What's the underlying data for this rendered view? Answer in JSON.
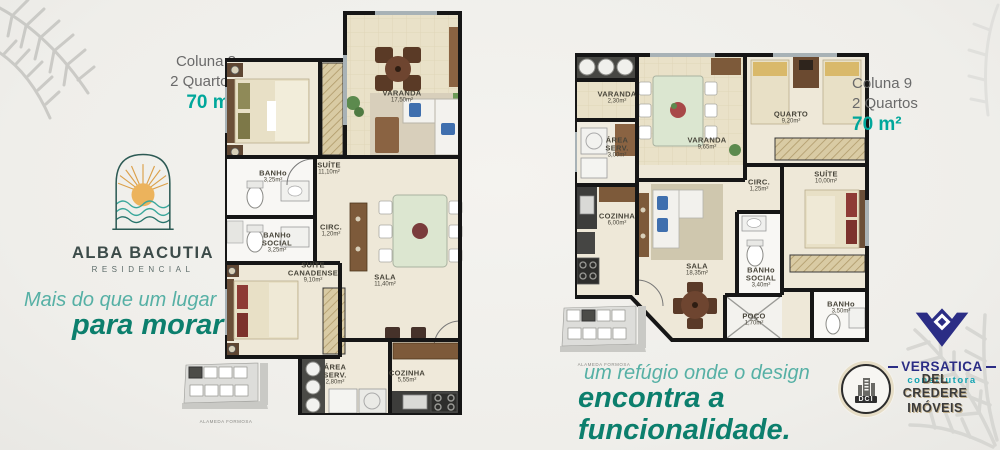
{
  "brand": {
    "name": "ALBA BACUTIA",
    "subtitle": "RESIDENCIAL"
  },
  "taglines": {
    "left1": "Mais do que um lugar",
    "left2": "para morar",
    "right1": "um refúgio onde o design",
    "right2": "encontra a funcionalidade."
  },
  "plan8": {
    "header": {
      "column": "Coluna 8",
      "type": "2 Quartos",
      "size": "70 m²"
    },
    "rooms": [
      {
        "name": "VARANDA",
        "area": "17,50m²"
      },
      {
        "name": "SUÍTE",
        "area": "11,10m²"
      },
      {
        "name": "BANHo",
        "area": "3,25m²"
      },
      {
        "name": "BANHo SOCIAL",
        "area": "3,25m²"
      },
      {
        "name": "CIRC.",
        "area": "1,20m²"
      },
      {
        "name": "SUÍTE CANADENSE",
        "area": "9,10m²"
      },
      {
        "name": "SALA",
        "area": "11,40m²"
      },
      {
        "name": "ÁREA SERV.",
        "area": "2,80m²"
      },
      {
        "name": "COZINHA",
        "area": "5,55m²"
      }
    ]
  },
  "plan9": {
    "header": {
      "column": "Coluna 9",
      "type": "2 Quartos",
      "size": "70 m²"
    },
    "rooms": [
      {
        "name": "VARANDA",
        "area": "2,30m²"
      },
      {
        "name": "ÁREA SERV.",
        "area": "3,00m²"
      },
      {
        "name": "VARANDA",
        "area": "9,65m²"
      },
      {
        "name": "QUARTO",
        "area": "9,20m²"
      },
      {
        "name": "CIRC.",
        "area": "1,25m²"
      },
      {
        "name": "SUÍTE",
        "area": "10,00m²"
      },
      {
        "name": "COZINHA",
        "area": "6,00m²"
      },
      {
        "name": "SALA",
        "area": "18,35m²"
      },
      {
        "name": "BANHo SOCIAL",
        "area": "3,40m²"
      },
      {
        "name": "POÇO",
        "area": "1,70m²"
      },
      {
        "name": "BANHo",
        "area": "3,50m²"
      }
    ]
  },
  "keyplan": {
    "street": "ALAMEDA FORMOSA"
  },
  "partners": {
    "versatica": {
      "name": "VERSATICA",
      "subtitle": "construtora"
    },
    "delcredere": {
      "badge": "DCI",
      "line1": "DEL CREDERE",
      "line2": "IMÓVEIS"
    }
  },
  "colors": {
    "accent_teal": "#00a79b",
    "teal_dark": "#0c7f6d",
    "teal_light": "#56b0a5",
    "heading_gray": "#6a6a6a",
    "versatica_navy": "#2b2d85",
    "versatica_teal": "#12a3b2",
    "wall_black": "#161616",
    "floor_beige": "#eee8d8",
    "background": "#f1efeb"
  }
}
